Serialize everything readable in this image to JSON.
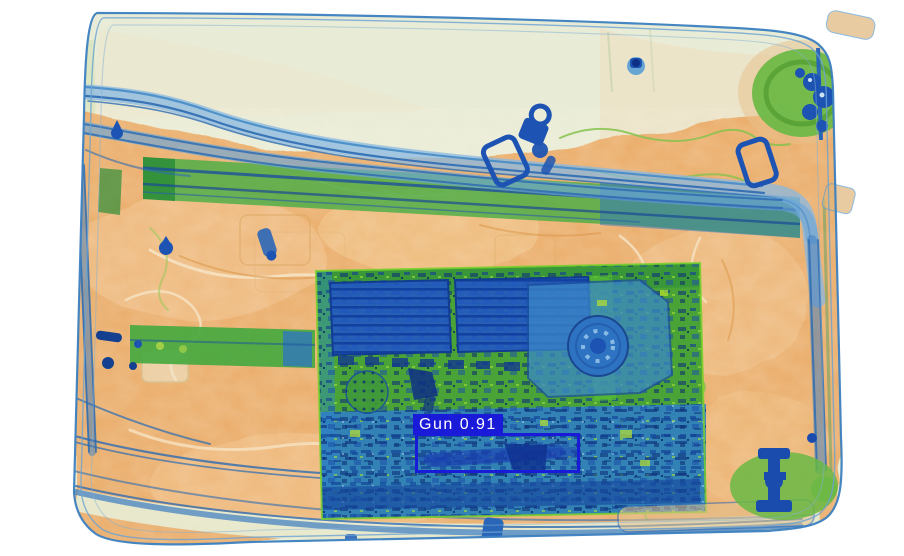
{
  "window": {
    "width": 904,
    "height": 556,
    "background": "#ffffff",
    "title": "X-ray baggage scan with object detection overlay"
  },
  "detection": {
    "label": "Gun",
    "confidence": 0.91,
    "display_text": "Gun 0.91",
    "box_color": "#1a1ad9",
    "text_color": "#ffffff",
    "box": {
      "left": 415,
      "top": 433,
      "width": 165,
      "height": 40
    },
    "label_box": {
      "left": 413,
      "top": 414
    }
  },
  "scene": {
    "kind": "xray-scan",
    "visible_objects": [
      "suitcase",
      "laptop-electronics",
      "gun"
    ],
    "palette": {
      "organic_orange": "#eaa55c",
      "metal_blue": "#1d53b2",
      "alloy_green": "#4aad45",
      "shell_cream": "#e6ecd4",
      "strap_blue": "#3c7cc0",
      "pcb_green": "#4aa337",
      "dense_blue": "#2e7ccc"
    }
  }
}
